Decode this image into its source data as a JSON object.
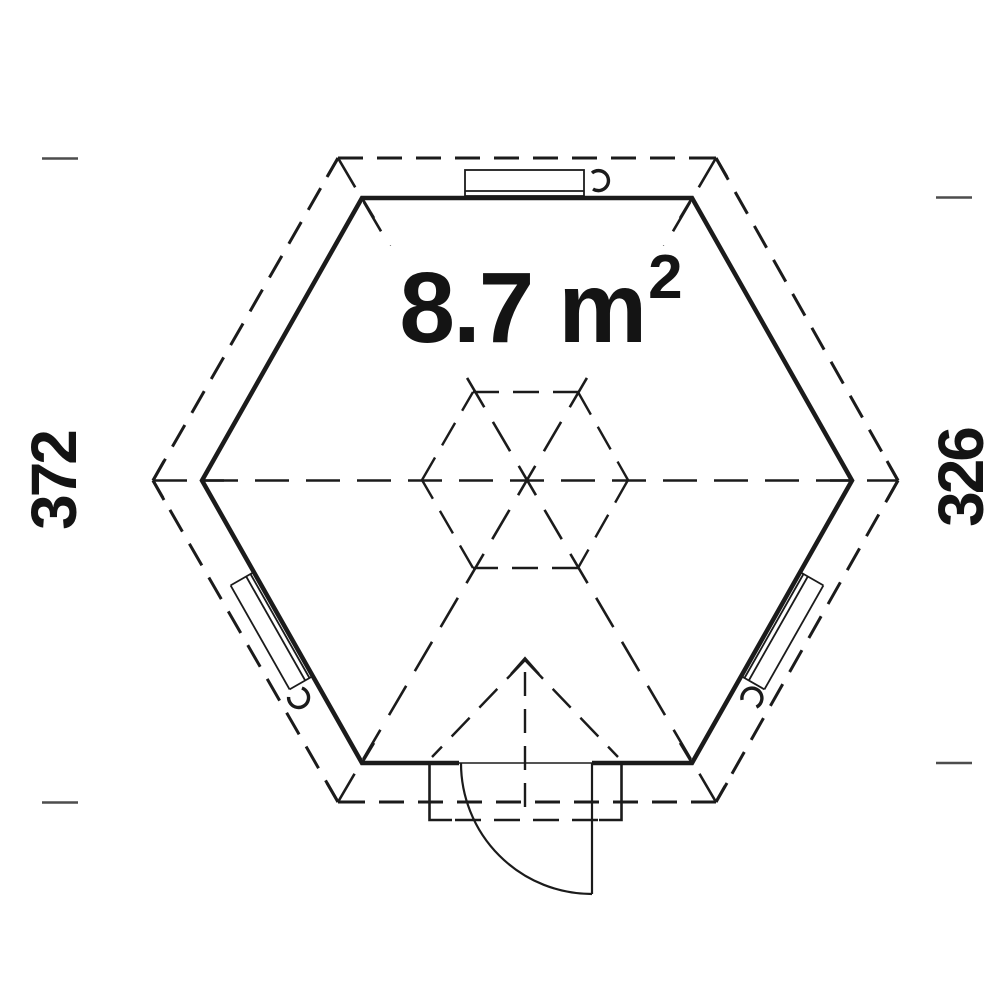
{
  "drawing": {
    "title": "hexagonal-garden-house-floor-plan",
    "area_label": {
      "value": "8.7 m",
      "exponent": "2",
      "full": "8.7 m²"
    },
    "dimensions": {
      "left": "372",
      "right": "326"
    },
    "colors": {
      "line": "#1b1b1b",
      "tick": "#4d4d4d",
      "text": "#141414",
      "background": "#ffffff"
    },
    "features": {
      "windows": 3,
      "doors": 1,
      "wall_outline": "solid hexagon",
      "roof_outline": "dashed hexagon"
    }
  }
}
